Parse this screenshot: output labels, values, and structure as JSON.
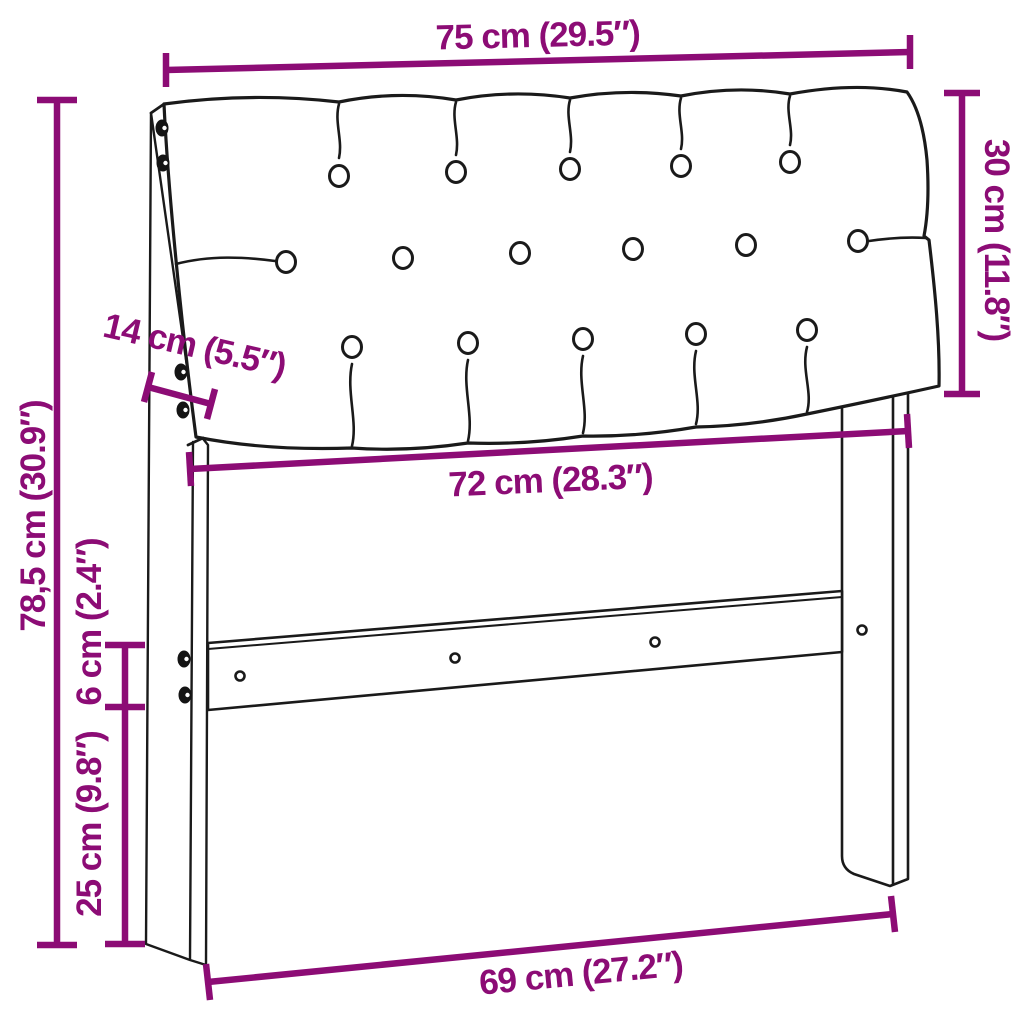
{
  "colors": {
    "accent": "#8C0C75",
    "outline": "#1A1A1A",
    "background": "#FFFFFF"
  },
  "dimensions": {
    "top_width": "75 cm (29.5″)",
    "cushion_height": "30 cm (11.8″)",
    "side_depth": "14 cm (5.5″)",
    "total_height": "78,5 cm (30.9″)",
    "inner_width": "72 cm (28.3″)",
    "rail_height": "6 cm (2.4″)",
    "leg_height": "25 cm (9.8″)",
    "bottom_width": "69 cm (27.2″)"
  },
  "tufting": {
    "button_rows": [
      5,
      6,
      5
    ]
  }
}
